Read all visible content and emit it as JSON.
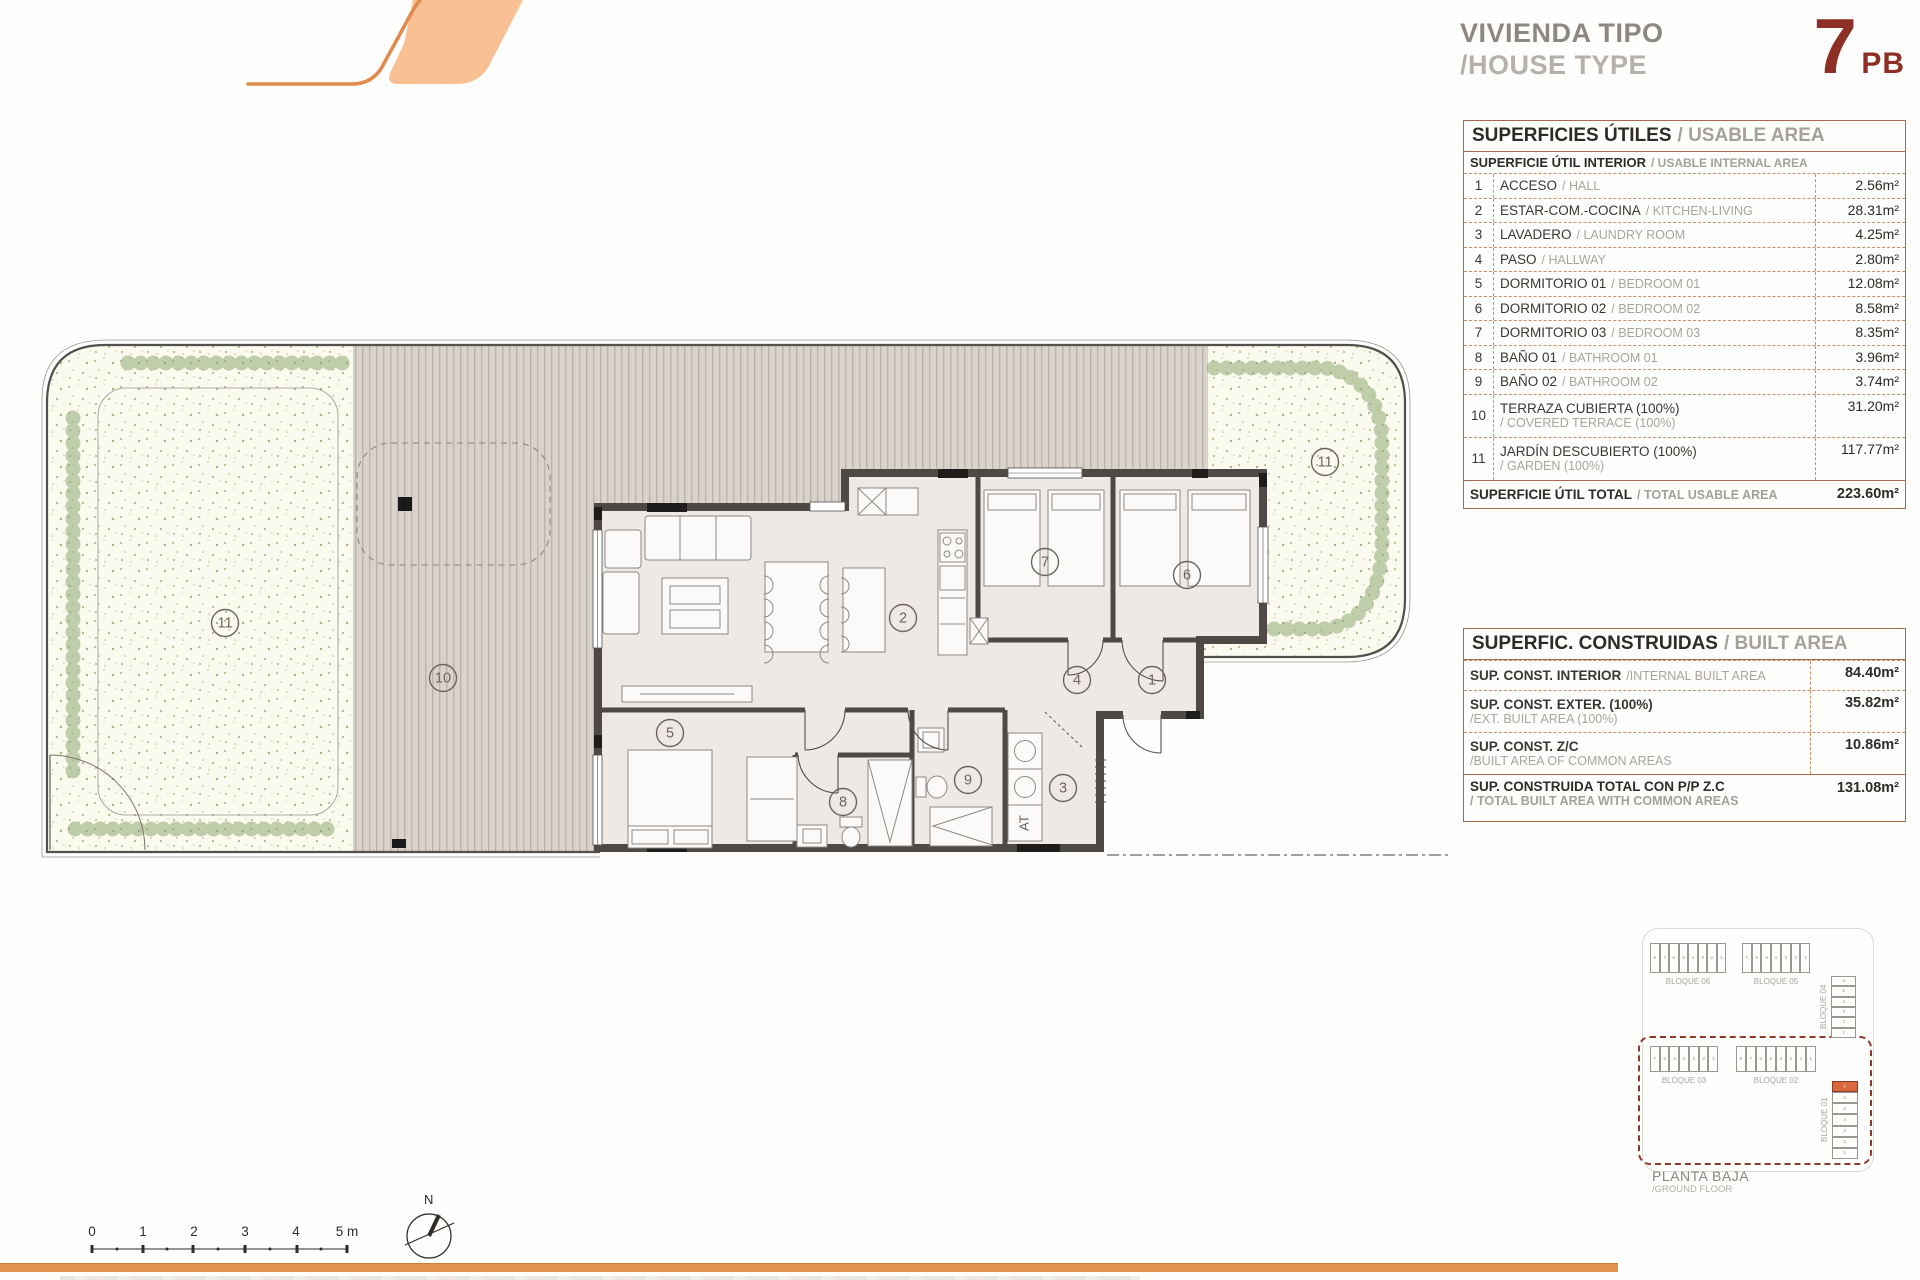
{
  "header": {
    "title_es": "VIVIENDA TIPO",
    "title_en": "/HOUSE TYPE",
    "type_number": "7",
    "type_code": "PB"
  },
  "usable_table": {
    "title_es": "SUPERFICIES ÚTILES",
    "title_en": "/ USABLE AREA",
    "subtitle_es": "SUPERFICIE ÚTIL INTERIOR",
    "subtitle_en": "/ USABLE INTERNAL AREA",
    "rows": [
      {
        "num": "1",
        "es": "ACCESO",
        "en": "/ HALL",
        "val": "2.56m²",
        "two_line": false
      },
      {
        "num": "2",
        "es": "ESTAR-COM.-COCINA",
        "en": "/ KITCHEN-LIVING",
        "val": "28.31m²",
        "two_line": false
      },
      {
        "num": "3",
        "es": "LAVADERO",
        "en": "/ LAUNDRY ROOM",
        "val": "4.25m²",
        "two_line": false
      },
      {
        "num": "4",
        "es": "PASO",
        "en": "/ HALLWAY",
        "val": "2.80m²",
        "two_line": false
      },
      {
        "num": "5",
        "es": "DORMITORIO 01",
        "en": "/ BEDROOM 01",
        "val": "12.08m²",
        "two_line": false
      },
      {
        "num": "6",
        "es": "DORMITORIO 02",
        "en": "/ BEDROOM 02",
        "val": "8.58m²",
        "two_line": false
      },
      {
        "num": "7",
        "es": "DORMITORIO 03",
        "en": "/ BEDROOM 03",
        "val": "8.35m²",
        "two_line": false
      },
      {
        "num": "8",
        "es": "BAÑO 01",
        "en": "/ BATHROOM 01",
        "val": "3.96m²",
        "two_line": false
      },
      {
        "num": "9",
        "es": "BAÑO 02",
        "en": "/ BATHROOM 02",
        "val": "3.74m²",
        "two_line": false
      },
      {
        "num": "10",
        "es": "TERRAZA CUBIERTA (100%)",
        "en": "/ COVERED TERRACE (100%)",
        "val": "31.20m²",
        "two_line": true
      },
      {
        "num": "11",
        "es": "JARDÍN DESCUBIERTO (100%)",
        "en": "/ GARDEN (100%)",
        "val": "117.77m²",
        "two_line": true
      }
    ],
    "total_es": "SUPERFICIE ÚTIL TOTAL",
    "total_en": "/ TOTAL USABLE AREA",
    "total_val": "223.60m²"
  },
  "built_table": {
    "title_es": "SUPERFIC. CONSTRUIDAS",
    "title_en": "/ BUILT AREA",
    "rows": [
      {
        "es": "SUP. CONST. INTERIOR",
        "en": "/INTERNAL BUILT AREA",
        "val": "84.40m²",
        "two_line": false
      },
      {
        "es": "SUP. CONST. EXTER. (100%)",
        "en": "/EXT. BUILT AREA (100%)",
        "val": "35.82m²",
        "two_line": true
      },
      {
        "es": "SUP. CONST. Z/C",
        "en": "/BUILT AREA OF COMMON AREAS",
        "val": "10.86m²",
        "two_line": true
      }
    ],
    "total_es": "SUP. CONSTRUIDA TOTAL CON P/P Z.C",
    "total_en": "/ TOTAL BUILT AREA WITH COMMON AREAS",
    "total_val": "131.08m²"
  },
  "plan": {
    "room_labels": [
      {
        "n": "11",
        "x": 185,
        "y": 293
      },
      {
        "n": "10",
        "x": 403,
        "y": 348
      },
      {
        "n": "2",
        "x": 863,
        "y": 288
      },
      {
        "n": "5",
        "x": 630,
        "y": 403
      },
      {
        "n": "8",
        "x": 803,
        "y": 472
      },
      {
        "n": "9",
        "x": 928,
        "y": 450
      },
      {
        "n": "3",
        "x": 1023,
        "y": 458
      },
      {
        "n": "4",
        "x": 1037,
        "y": 350
      },
      {
        "n": "1",
        "x": 1112,
        "y": 350
      },
      {
        "n": "7",
        "x": 1005,
        "y": 232
      },
      {
        "n": "6",
        "x": 1147,
        "y": 245
      },
      {
        "n": "11",
        "x": 1285,
        "y": 132
      }
    ],
    "at_label": "AT"
  },
  "minimap": {
    "blocks": [
      {
        "label": "BLOQUE 06",
        "cells": [
          "8",
          "7",
          "6",
          "5",
          "4",
          "3",
          "2",
          "1"
        ],
        "orientation": "h"
      },
      {
        "label": "BLOQUE 05",
        "cells": [
          "7",
          "6",
          "5",
          "4",
          "3",
          "2",
          "1"
        ],
        "orientation": "h"
      },
      {
        "label": "BLOQUE 04",
        "cells": [
          "6",
          "5",
          "4",
          "3",
          "2",
          "1"
        ],
        "orientation": "v"
      },
      {
        "label": "BLOQUE 03",
        "cells": [
          "7",
          "6",
          "5",
          "4",
          "3",
          "2",
          "1"
        ],
        "orientation": "h"
      },
      {
        "label": "BLOQUE 02",
        "cells": [
          "8",
          "7",
          "6",
          "5",
          "4",
          "3",
          "2",
          "1"
        ],
        "orientation": "h"
      },
      {
        "label": "BLOQUE 01",
        "cells": [
          "7",
          "6",
          "5",
          "4",
          "3",
          "2",
          "1"
        ],
        "orientation": "v",
        "highlight": "7"
      }
    ],
    "caption_es": "PLANTA BAJA",
    "caption_en": "/GROUND FLOOR"
  },
  "scale_bar": {
    "ticks": [
      "0",
      "1",
      "2",
      "3",
      "4",
      "5"
    ],
    "unit": "m"
  },
  "compass": {
    "label": "N"
  },
  "colors": {
    "accent_orange": "#E2924F",
    "logo_fill": "#F9C094",
    "type_red": "#8E2F26",
    "table_border": "#A66A4B",
    "wall": "#4E4945",
    "terrace": "#DAD3CC",
    "garden": "#FBFAEF",
    "hedge": "#8FA872",
    "highlight_cell": "#D9683C"
  }
}
